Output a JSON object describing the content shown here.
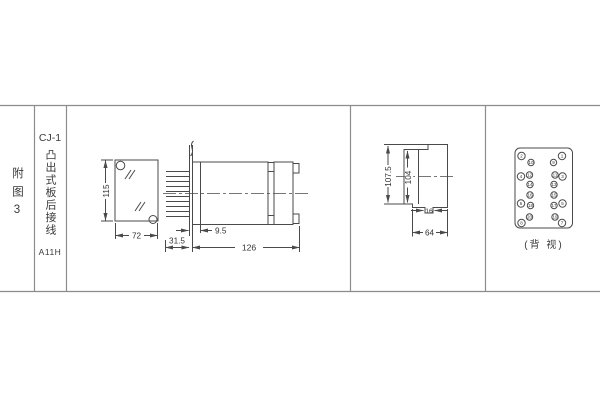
{
  "title_block": {
    "figure_label": "附图3",
    "model": "CJ-1",
    "mounting": "凸出式板后接线",
    "code": "A11H"
  },
  "front_view": {
    "dim_height": "115",
    "dim_width": "72"
  },
  "side_view": {
    "dim_pin_length": "31.5",
    "dim_offset": "9.5",
    "dim_depth": "126"
  },
  "profile_view": {
    "dim_total_height": "107.5",
    "dim_body_height": "104",
    "dim_stub_width": "16",
    "dim_flange_width": "64"
  },
  "terminal_view": {
    "caption": "(背 视)",
    "left_outer": [
      "2",
      "4",
      "6",
      "8"
    ],
    "left_inner": [
      "10",
      "12",
      "14",
      "16",
      "18",
      "20"
    ],
    "right_inner": [
      "9",
      "11",
      "13",
      "15",
      "17",
      "19"
    ],
    "right_outer": [
      "1",
      "3",
      "5",
      "7"
    ]
  },
  "colors": {
    "drawing_line": "#4a4a4a",
    "table_line": "#8c8c8c",
    "text": "#3a3a3a",
    "background": "#ffffff"
  }
}
